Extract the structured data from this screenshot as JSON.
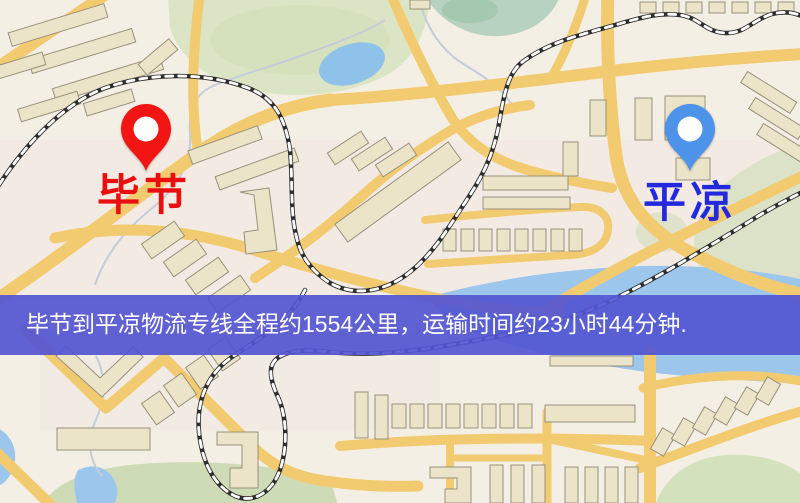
{
  "banner": {
    "text": "毕节到平凉物流专线全程约1554公里，运输时间约23小时44分钟.",
    "background_color": "#5255d1",
    "text_color": "#ffffff"
  },
  "markers": [
    {
      "id": "origin",
      "label": "毕节",
      "pin_color": "#f31414",
      "label_color": "#e90f10"
    },
    {
      "id": "destination",
      "label": "平凉",
      "pin_color": "#4d93ea",
      "label_color": "#2429dd"
    }
  ],
  "route": {
    "origin": "毕节",
    "destination": "平凉",
    "service": "物流专线",
    "distance": "约1554公里",
    "duration": "约23小时44分钟"
  },
  "map_palette": {
    "background": "#f4efe5",
    "road": "#f2cb70",
    "building_fill": "#ece4c9",
    "building_outline": "#98907a",
    "green_area": "#d9e4c4",
    "water": "#9dc6ec",
    "railway": "#2d2d2d"
  }
}
